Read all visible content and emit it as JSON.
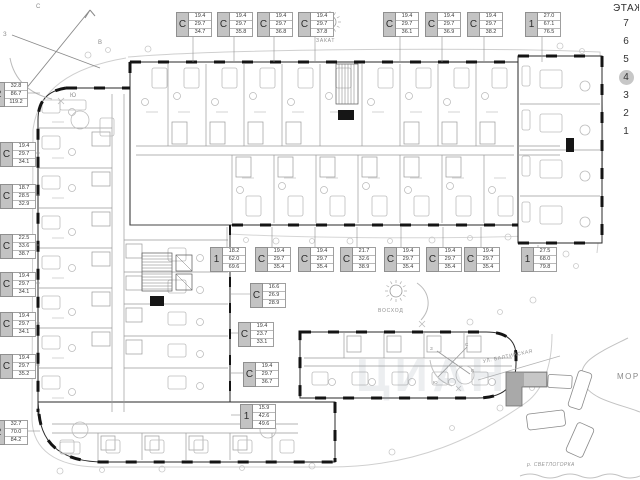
{
  "floor_selector": {
    "title": "ЭТАЖ",
    "floors": [
      "7",
      "6",
      "5",
      "4",
      "3",
      "2",
      "1"
    ],
    "active_floor": "4"
  },
  "orientation": {
    "sunset_label": "ЗАКАТ",
    "sunrise_label": "ВОСХОД",
    "compass": {
      "north": "С",
      "east": "В",
      "south": "Ю",
      "west": "З"
    }
  },
  "minimap": {
    "street_label": "УЛ. БАЛТИЙСКАЯ",
    "sea_label": "МОРЕ",
    "river_label": "р. СВЕТЛОГОРКА"
  },
  "watermark": "ЦИАН",
  "unit_labels": {
    "top_row": [
      {
        "type": "С",
        "areas": [
          "19.4",
          "29.7",
          "34.7"
        ],
        "x": 176,
        "y": 12
      },
      {
        "type": "С",
        "areas": [
          "19.4",
          "29.7",
          "35.8"
        ],
        "x": 217,
        "y": 12
      },
      {
        "type": "С",
        "areas": [
          "19.4",
          "29.7",
          "36.8"
        ],
        "x": 257,
        "y": 12
      },
      {
        "type": "С",
        "areas": [
          "19.4",
          "29.7",
          "37.8"
        ],
        "x": 298,
        "y": 12
      },
      {
        "type": "С",
        "areas": [
          "19.4",
          "29.7",
          "36.1"
        ],
        "x": 383,
        "y": 12
      },
      {
        "type": "С",
        "areas": [
          "19.4",
          "29.7",
          "36.9"
        ],
        "x": 425,
        "y": 12
      },
      {
        "type": "С",
        "areas": [
          "19.4",
          "29.7",
          "38.2"
        ],
        "x": 467,
        "y": 12
      },
      {
        "type": "1",
        "areas": [
          "27.0",
          "67.1",
          "76.5"
        ],
        "x": 525,
        "y": 12
      }
    ],
    "left_column": [
      {
        "type": "2",
        "areas": [
          "32.8",
          "86.7",
          "119.2"
        ],
        "x": -8,
        "y": 82
      },
      {
        "type": "С",
        "areas": [
          "19.4",
          "29.7",
          "34.1"
        ],
        "x": 0,
        "y": 142
      },
      {
        "type": "С",
        "areas": [
          "18.7",
          "28.5",
          "32.9"
        ],
        "x": 0,
        "y": 184
      },
      {
        "type": "С",
        "areas": [
          "22.5",
          "33.6",
          "38.7"
        ],
        "x": 0,
        "y": 234
      },
      {
        "type": "С",
        "areas": [
          "19.4",
          "29.7",
          "34.1"
        ],
        "x": 0,
        "y": 272
      },
      {
        "type": "С",
        "areas": [
          "19.4",
          "29.7",
          "34.1"
        ],
        "x": 0,
        "y": 312
      },
      {
        "type": "С",
        "areas": [
          "19.4",
          "29.7",
          "35.2"
        ],
        "x": 0,
        "y": 354
      },
      {
        "type": "2",
        "areas": [
          "32.7",
          "70.0",
          "84.2"
        ],
        "x": -8,
        "y": 420
      }
    ],
    "courtyard_row": [
      {
        "type": "1",
        "areas": [
          "18.2",
          "62.0",
          "69.6"
        ],
        "x": 210,
        "y": 247
      },
      {
        "type": "С",
        "areas": [
          "19.4",
          "29.7",
          "35.4"
        ],
        "x": 255,
        "y": 247
      },
      {
        "type": "С",
        "areas": [
          "19.4",
          "29.7",
          "35.4"
        ],
        "x": 298,
        "y": 247
      },
      {
        "type": "С",
        "areas": [
          "21.7",
          "32.6",
          "38.9"
        ],
        "x": 340,
        "y": 247
      },
      {
        "type": "С",
        "areas": [
          "19.4",
          "29.7",
          "35.4"
        ],
        "x": 384,
        "y": 247
      },
      {
        "type": "С",
        "areas": [
          "19.4",
          "29.7",
          "35.4"
        ],
        "x": 426,
        "y": 247
      },
      {
        "type": "С",
        "areas": [
          "19.4",
          "29.7",
          "35.4"
        ],
        "x": 464,
        "y": 247
      },
      {
        "type": "1",
        "areas": [
          "27.5",
          "68.0",
          "79.8"
        ],
        "x": 521,
        "y": 247
      }
    ],
    "inner_column": [
      {
        "type": "С",
        "areas": [
          "16.6",
          "26.9",
          "28.9"
        ],
        "x": 250,
        "y": 283
      },
      {
        "type": "С",
        "areas": [
          "19.4",
          "23.7",
          "33.1"
        ],
        "x": 238,
        "y": 322
      },
      {
        "type": "С",
        "areas": [
          "19.4",
          "29.7",
          "36.7"
        ],
        "x": 243,
        "y": 362
      },
      {
        "type": "1",
        "areas": [
          "15.9",
          "42.6",
          "49.6"
        ],
        "x": 240,
        "y": 404
      }
    ]
  }
}
